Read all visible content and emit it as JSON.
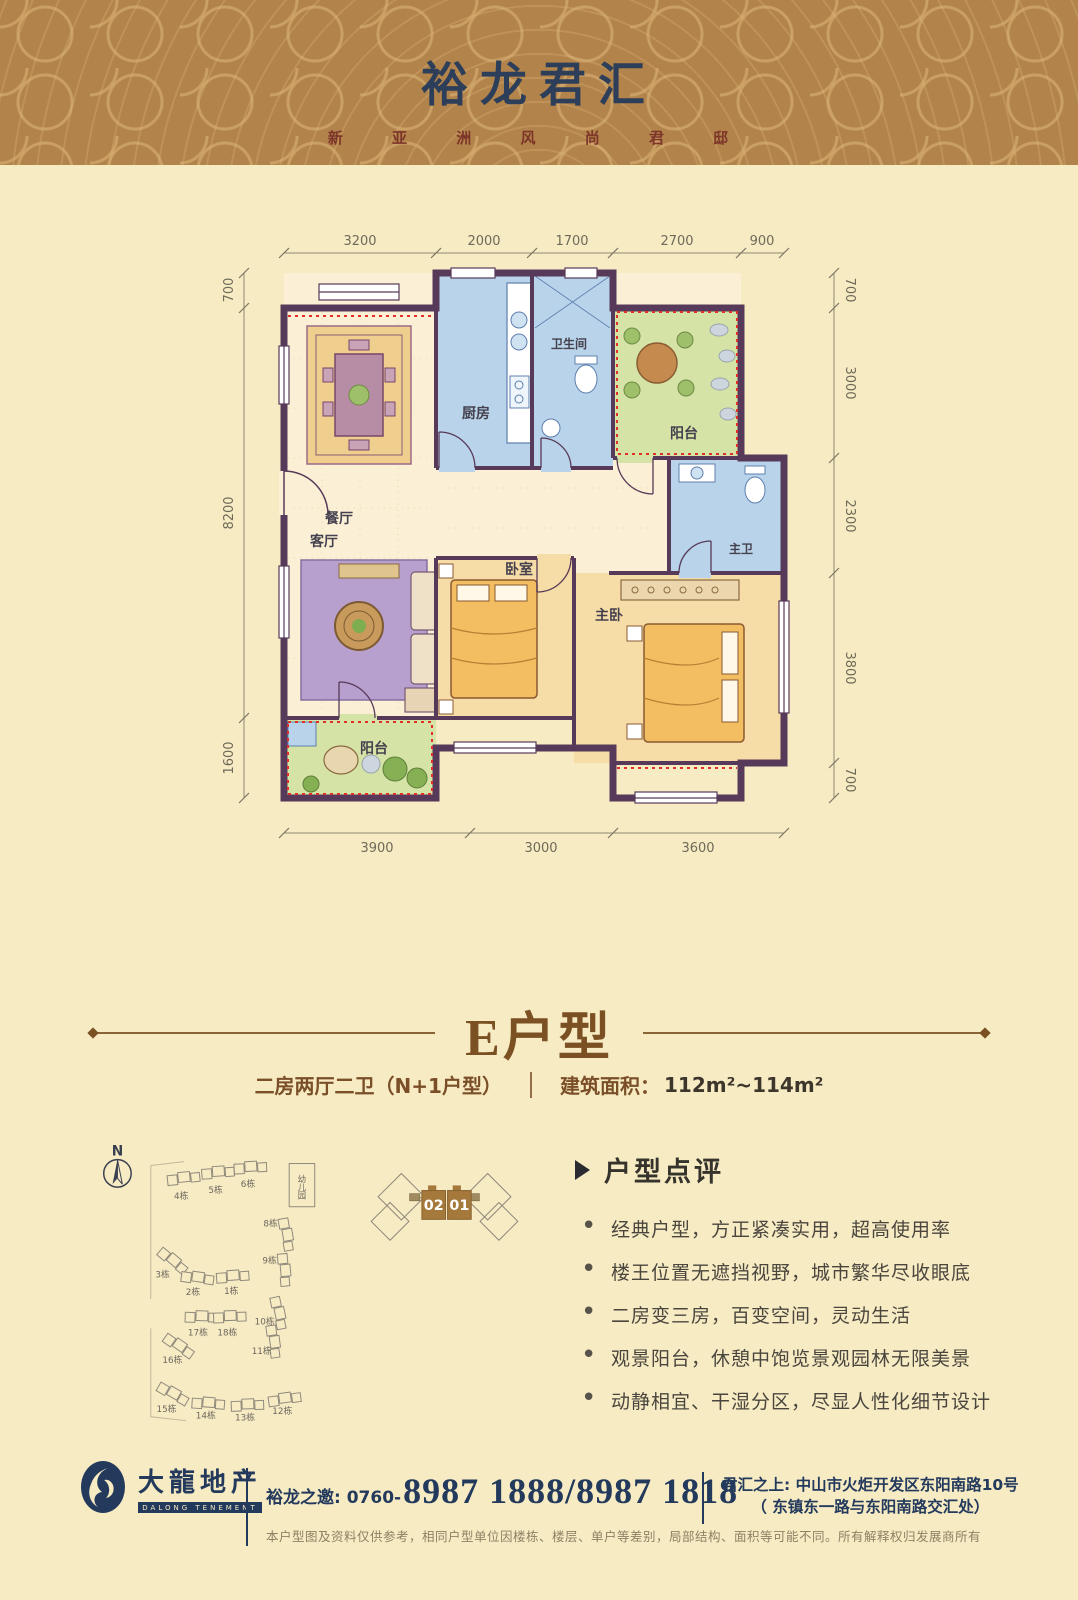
{
  "header": {
    "title": "裕龙君汇",
    "subtitle": "新 亚 洲 风 尚 君 邸"
  },
  "floor_plan": {
    "dims_top": [
      "3200",
      "2000",
      "1700",
      "2700",
      "900"
    ],
    "dims_left": [
      "700",
      "8200",
      "1600"
    ],
    "dims_right": [
      "700",
      "3000",
      "2300",
      "3800",
      "700"
    ],
    "dims_bottom": [
      "3900",
      "3000",
      "3600"
    ],
    "rooms": {
      "dining": "餐厅",
      "kitchen": "厨房",
      "bath": "卫生间",
      "balcony_top": "阳台",
      "master_bath": "主卫",
      "living": "客厅",
      "bedroom": "卧室",
      "master_bedroom": "主卧",
      "balcony_bottom": "阳台"
    }
  },
  "unit": {
    "title": "E户型",
    "spec": "二房两厅二卫（N+1户型）",
    "area_label": "建筑面积：",
    "area_value": "112m²~114m²"
  },
  "site_plan": {
    "north_label": "N",
    "kindergarten": "幼儿园",
    "buildings": [
      "4栋",
      "5栋",
      "6栋",
      "8栋",
      "3栋",
      "2栋",
      "1栋",
      "9栋",
      "17栋",
      "18栋",
      "10栋",
      "16栋",
      "11栋",
      "15栋",
      "14栋",
      "13栋",
      "12栋"
    ]
  },
  "locator": {
    "unit_left": "02",
    "unit_right": "01"
  },
  "review": {
    "title": "户型点评",
    "bullets": [
      "经典户型，方正紧凑实用，超高使用率",
      "楼王位置无遮挡视野，城市繁华尽收眼底",
      "二房变三房，百变空间，灵动生活",
      "观景阳台，休憩中饱览景观园林无限美景",
      "动静相宜、干湿分区，尽显人性化细节设计"
    ]
  },
  "footer": {
    "logo_name": "大龍地产",
    "logo_en": "DALONG TENEMENT",
    "phone_label": "裕龙之邀: 0760-",
    "phone_numbers": "8987 1888/8987 1818",
    "address_line1": "君汇之上: 中山市火炬开发区东阳南路10号",
    "address_line2": "（ 东镇东一路与东阳南路交汇处）",
    "disclaimer": "本户型图及资料仅供参考，相同户型单位因楼栋、楼层、单户等差别，局部结构、面积等可能不同。所有解释权归发展商所有"
  },
  "colors": {
    "page_bg": "#f7ebc4",
    "header_bg": "#b2834b",
    "title_navy": "#2c3e59",
    "subtitle_red": "#7d3529",
    "accent_brown": "#7b5023",
    "wall_purple": "#573a59",
    "room_blue": "#b9d4ea",
    "room_green": "#d6e3a6",
    "room_orange": "#f6dca6",
    "red_dotted": "#e23028",
    "footer_navy": "#233a5c"
  }
}
